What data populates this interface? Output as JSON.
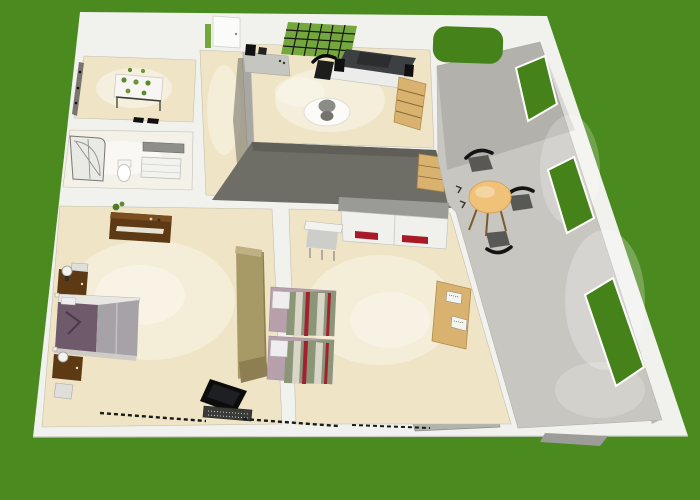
{
  "canvas": {
    "width": 700,
    "height": 500
  },
  "colors": {
    "bg": "#4a8a1e",
    "wall": "#f1f1ee",
    "wall-bright": "#fbfbf9",
    "wall-gray": "#9c9c98",
    "wall-inner": "#b9b8b4",
    "dark-band": "#6f6e66",
    "dark-face": "#5f5e57",
    "floor-beige": "#efe5c6",
    "floor-white": "#f3f1e8",
    "floor-marble": "#c7c6c0",
    "window-green": "#45821a",
    "grid-green": "#74a83c",
    "wood-dark": "#5d3a14",
    "wood-tan": "#a89a66",
    "wood-tan-dark": "#8d7f52",
    "shelf-tan": "#d8b26e",
    "table-wood": "#f0c279",
    "chair-gray": "#585855",
    "black": "#101010",
    "bed-purple": "#6f5a6c",
    "bed-gray": "#a6a2a8",
    "pillow-white": "#efedf0",
    "mattress-pink": "#b7a0ac",
    "stripe-olive": "#8b9678",
    "stripe-red": "#a32030",
    "stripe-cream": "#d9d6c8",
    "red-accent": "#a81a28",
    "counter-gray": "#c6c6c1",
    "desk-dark": "#3d4043",
    "white-furn": "#ececea"
  },
  "scene": {
    "style": "3d-overhead-floor-plan-render",
    "environment": "green-lawn-background",
    "rooms": [
      {
        "id": "plant-room",
        "furniture": [
          "plant-table",
          "potted-plants",
          "wall-rack"
        ]
      },
      {
        "id": "bathroom",
        "furniture": [
          "corner-shower",
          "toilet",
          "wall-mirror",
          "vanity-cabinet"
        ]
      },
      {
        "id": "entry-hall",
        "furniture": [
          "entry-door",
          "glass-sidelight"
        ]
      },
      {
        "id": "study",
        "furniture": [
          "glass-grid-window",
          "computer-desk",
          "desk-chair",
          "counter",
          "round-glass-table",
          "ladder-shelf"
        ]
      },
      {
        "id": "living-dining",
        "furniture": [
          "round-dining-table",
          "dining-chairs-x3",
          "sideboard",
          "storage-chest"
        ],
        "window_openings": 3,
        "arched_opening": 1
      },
      {
        "id": "master-bedroom",
        "furniture": [
          "double-bed",
          "nightstand-lamp-x2",
          "dresser",
          "stool",
          "side-table",
          "tv",
          "tv-stand",
          "tall-wardrobe"
        ]
      },
      {
        "id": "kids-bedroom",
        "furniture": [
          "single-bed-x2",
          "wardrobe-red-accents",
          "desk",
          "desk-chair",
          "pin-board"
        ]
      }
    ]
  }
}
